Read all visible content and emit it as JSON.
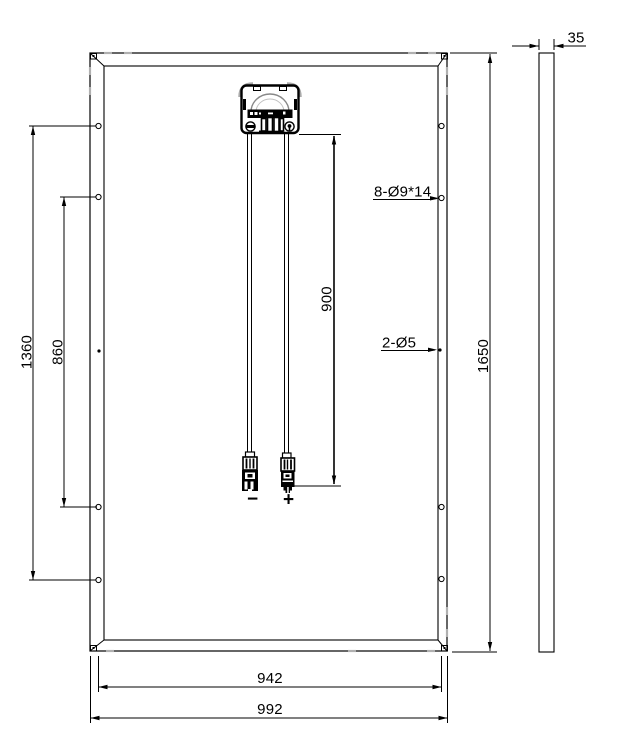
{
  "colors": {
    "line": "#000000",
    "shade_tick": "#b0b0b0",
    "background": "#ffffff"
  },
  "dimensions": {
    "overall_height": "1650",
    "mounting_span_outer": "1360",
    "mounting_span_inner": "860",
    "cable_length": "900",
    "hole_span_width": "942",
    "overall_width": "992",
    "frame_thickness": "35"
  },
  "callouts": {
    "mounting_holes": "8-Ø9*14",
    "grounding_holes": "2-Ø5"
  },
  "polarity": {
    "negative": "−",
    "positive": "+"
  }
}
